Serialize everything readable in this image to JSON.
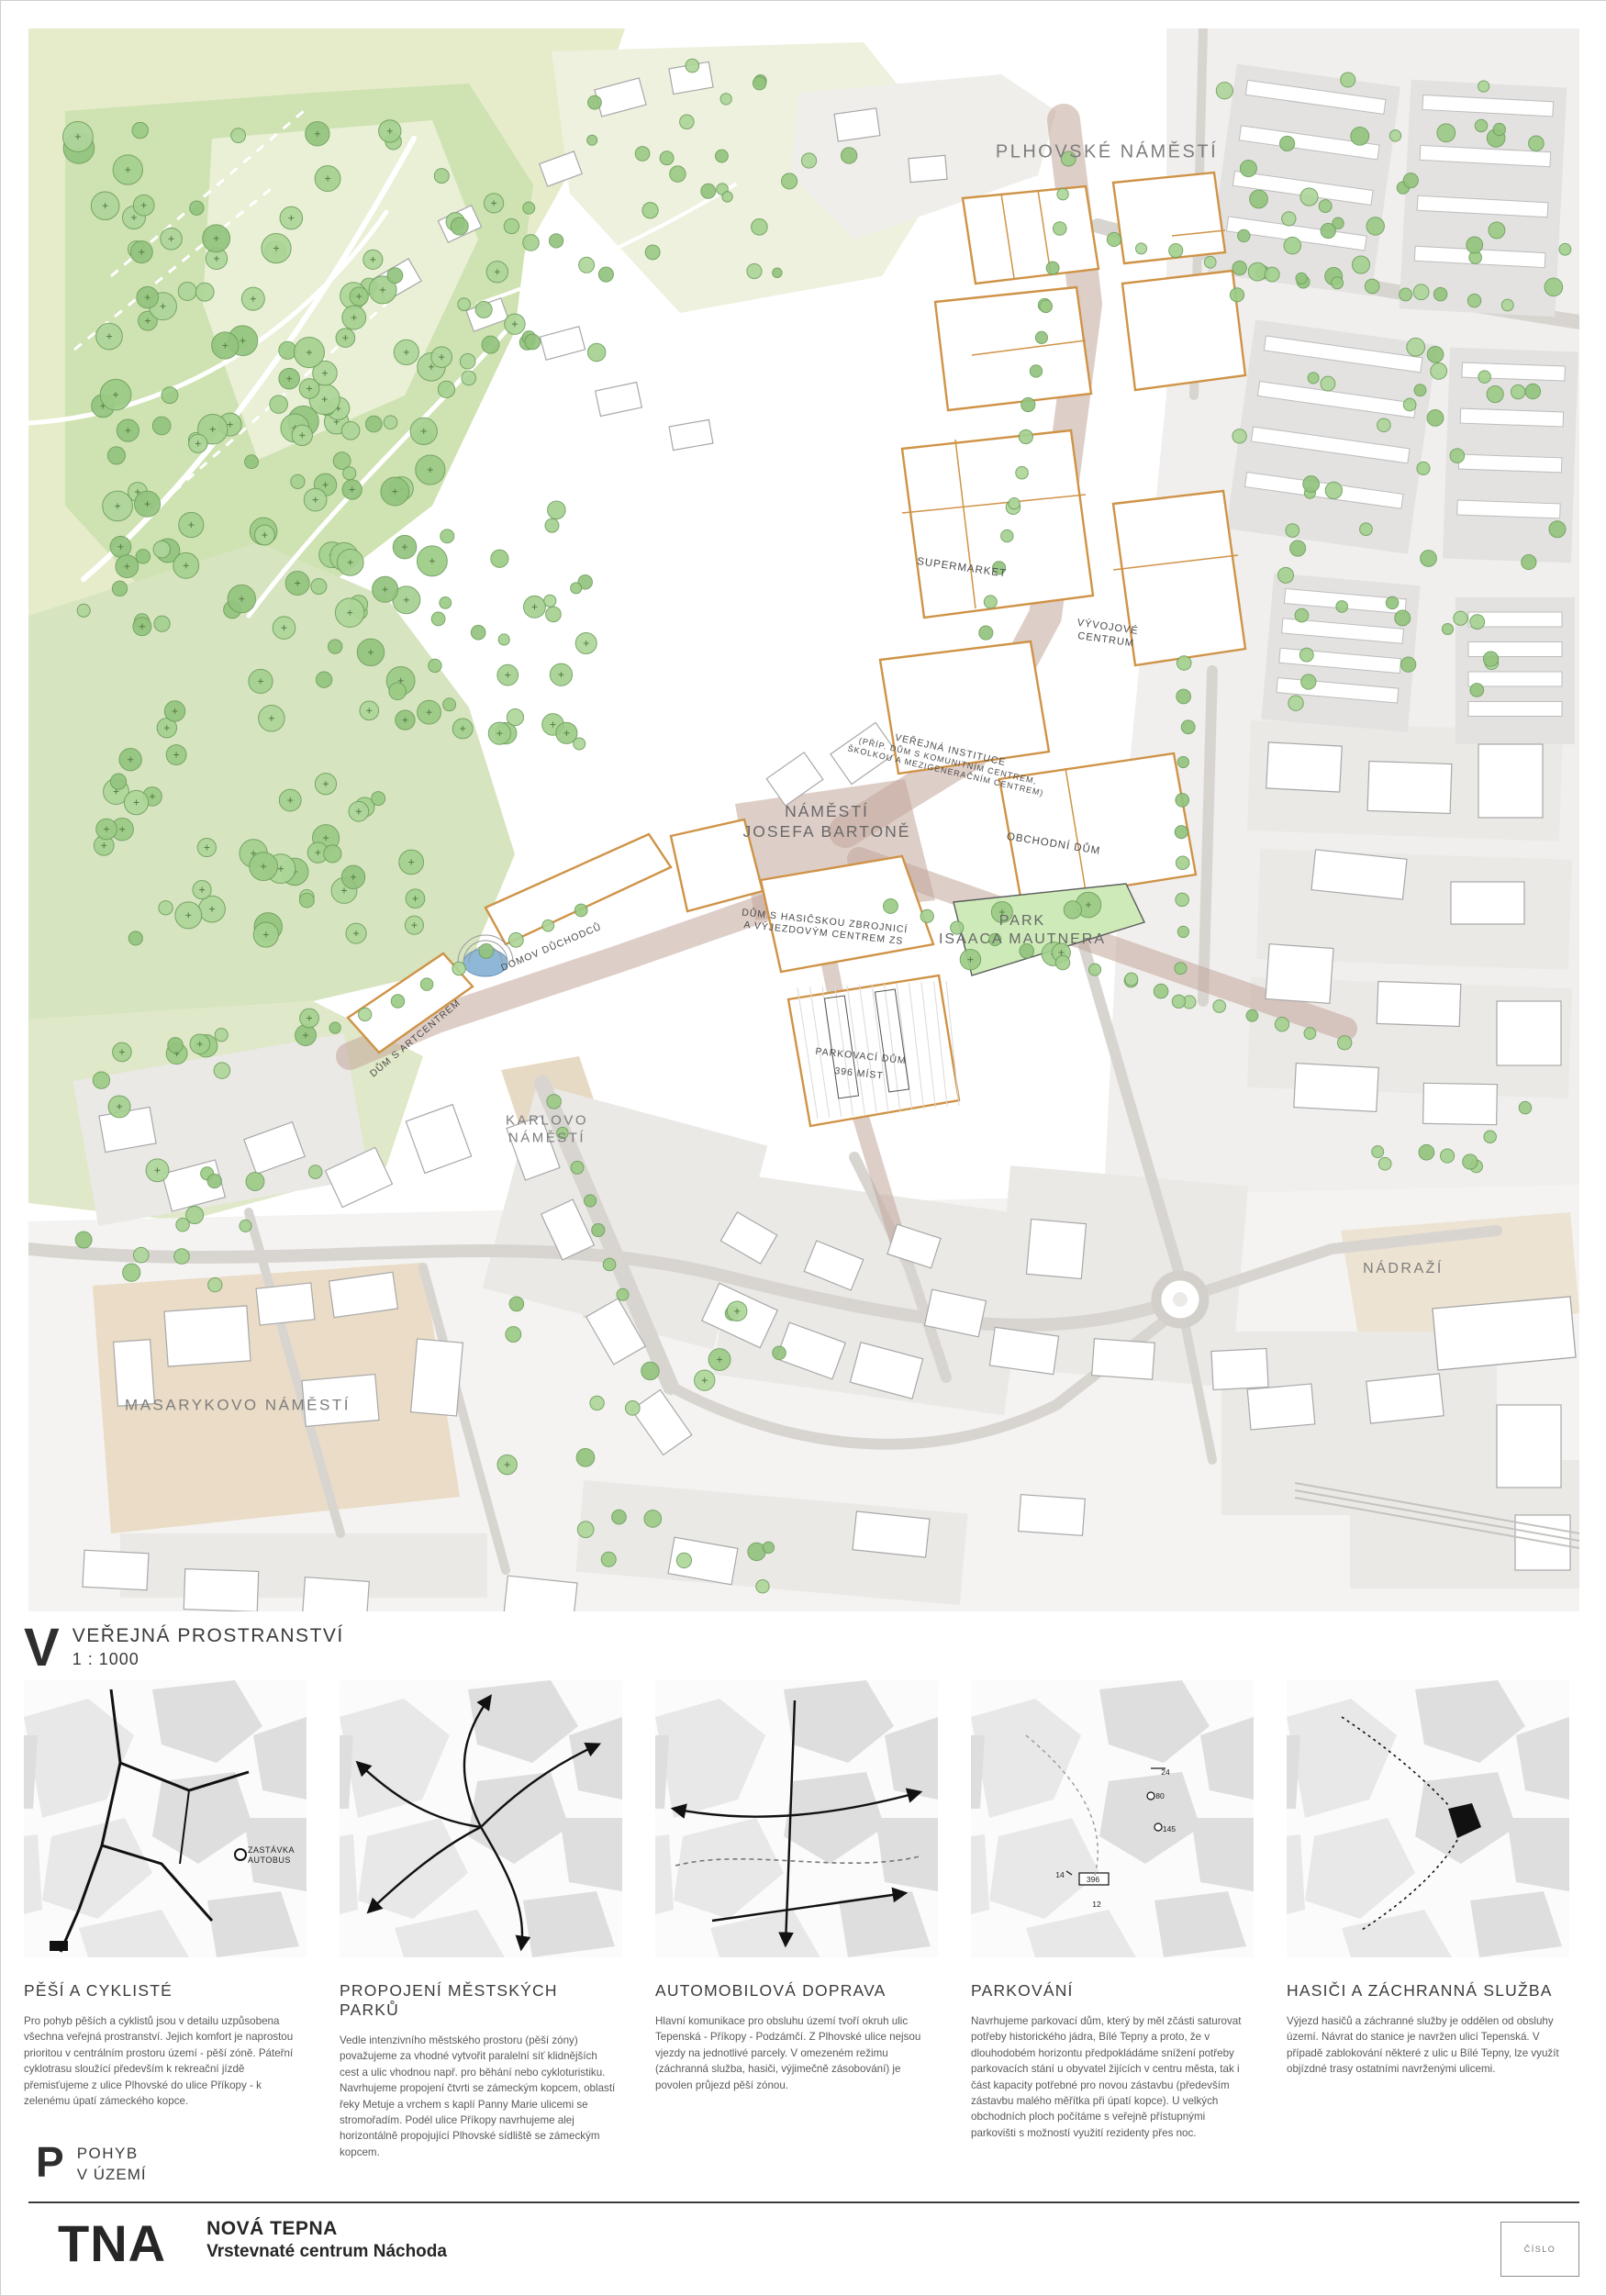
{
  "map": {
    "labels": {
      "plhovske": "PLHOVSKÉ NÁMĚSTÍ",
      "supermarket": "SUPERMARKET",
      "vyvojove1": "VÝVOJOVÉ",
      "vyvojove2": "CENTRUM",
      "instituce1": "VEŘEJNÁ INSTITUCE",
      "instituce2": "(PŘÍP. DŮM S KOMUNITNÍM CENTREM,",
      "instituce3": "ŠKOLKOU A MEZIGENERAČNÍM CENTREM)",
      "namesti1": "NÁMĚSTÍ",
      "namesti2": "JOSEFA BARTONĚ",
      "obchodni": "OBCHODNÍ DŮM",
      "park1": "PARK",
      "park2": "ISAACA MAUTNERA",
      "hasici1": "DŮM S HASIČSKOU ZBROJNICÍ",
      "hasici2": "A VÝJEZDOVÝM CENTREM ZS",
      "parkovaci1": "PARKOVACÍ DŮM",
      "parkovaci2": "396 MÍST",
      "domov": "DOMOV DŮCHODCŮ",
      "artcentrum": "DŮM S ARTCENTREM",
      "karlovo1": "KARLOVO",
      "karlovo2": "NÁMĚSTÍ",
      "masarykovo": "MASARYKOVO NÁMĚSTÍ",
      "nadrazi": "NÁDRAŽÍ"
    }
  },
  "section_v": {
    "letter": "V",
    "title": "VEŘEJNÁ PROSTRANSTVÍ",
    "scale": "1 : 1000"
  },
  "section_p": {
    "letter": "P",
    "line1": "POHYB",
    "line2": "V ÚZEMÍ"
  },
  "thumbnails": {
    "bus_stop_line1": "ZASTÁVKA",
    "bus_stop_line2": "AUTOBUS",
    "parking_numbers": {
      "n24": "24",
      "n80": "80",
      "n145": "145",
      "n396": "396",
      "n14": "14",
      "n12": "12"
    }
  },
  "panels": [
    {
      "heading": "PĚŠÍ A CYKLISTÉ",
      "body": "Pro pohyb pěších a cyklistů jsou v detailu uzpůsobena všechna veřejná prostranství. Jejich komfort je naprostou prioritou v centrálním prostoru území - pěší zóně. Páteřní cyklotrasu sloužící především k rekreační jízdě přemisťujeme z ulice Plhovské do ulice Příkopy - k zelenému úpatí zámeckého kopce."
    },
    {
      "heading": "PROPOJENÍ MĚSTSKÝCH PARKŮ",
      "body": "Vedle intenzivního městského prostoru (pěší zóny) považujeme za vhodné vytvořit paralelní síť klidnějších cest a ulic vhodnou např. pro běhání nebo cykloturistiku. Navrhujeme propojení čtvrti se zámeckým kopcem, oblastí řeky Metuje a vrchem s kaplí Panny Marie ulicemi se stromořadím. Podél ulice Příkopy navrhujeme alej horizontálně propojující Plhovské sídliště se zámeckým kopcem."
    },
    {
      "heading": "AUTOMOBILOVÁ DOPRAVA",
      "body": "Hlavní komunikace pro obsluhu území tvoří okruh ulic Tepenská - Příkopy - Podzámčí. Z Plhovské ulice nejsou vjezdy na jednotlivé parcely. V omezeném režimu (záchranná služba, hasiči, výjimečně zásobování) je povolen průjezd pěší zónou."
    },
    {
      "heading": "PARKOVÁNÍ",
      "body": "Navrhujeme parkovací dům, který by měl zčásti saturovat potřeby historického jádra, Bílé Tepny a proto, že v dlouhodobém horizontu předpokládáme snížení potřeby parkovacích stání u obyvatel žijících v centru města, tak i část kapacity potřebné pro novou zástavbu (především zástavbu malého měřítka při úpatí kopce). U velkých obchodních ploch počítáme s veřejně přístupnými parkovišti s možností využití rezidenty přes noc."
    },
    {
      "heading": "HASIČI A ZÁCHRANNÁ SLUŽBA",
      "body": "Výjezd hasičů a záchranné služby je oddělen od obsluhy území. Návrat do stanice je navržen ulicí Tepenská. V případě zablokování některé z ulic u Bílé Tepny, lze využít objízdné trasy ostatními navrženými ulicemi."
    }
  ],
  "footer": {
    "logo": "TNA",
    "project": "NOVÁ TEPNA",
    "subtitle": "Vrstevnaté centrum Náchoda",
    "number_box": "ČÍSLO"
  },
  "colors": {
    "accent_orange": "#cf9347",
    "park_green": "#cfe2b2",
    "tree_green": "#9ccb86",
    "pedestrian": "#c2a69b",
    "water": "#8fb8d8"
  }
}
